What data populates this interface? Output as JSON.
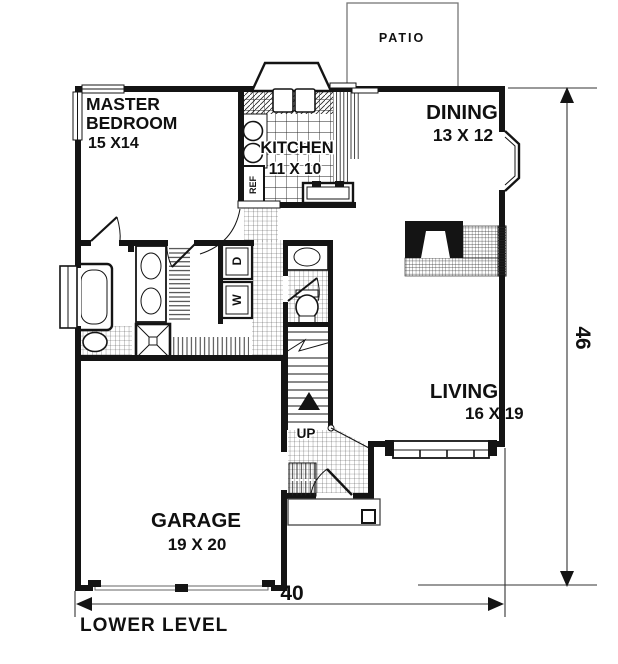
{
  "plan": {
    "title": "LOWER LEVEL",
    "overall_width": "40",
    "overall_depth": "46"
  },
  "rooms": {
    "master": {
      "line1": "MASTER",
      "line2": "BEDROOM",
      "dims": "15 X14"
    },
    "kitchen": {
      "name": "KITCHEN",
      "dims": "11 X 10"
    },
    "dining": {
      "name": "DINING",
      "dims": "13 X 12"
    },
    "living": {
      "name": "LIVING",
      "dims": "16 X 19"
    },
    "garage": {
      "name": "GARAGE",
      "dims": "19 X 20"
    },
    "patio": {
      "name": "PATIO"
    }
  },
  "fixtures": {
    "stairs_direction": "UP",
    "washer": "W",
    "dryer": "D",
    "refrigerator": "REF"
  },
  "colors": {
    "ink": "#141414",
    "paper": "#ffffff"
  }
}
